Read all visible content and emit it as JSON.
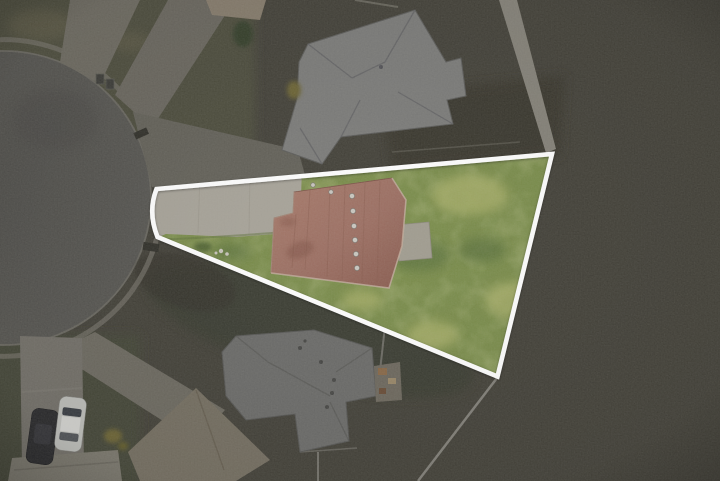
{
  "scene": {
    "kind": "aerial-drone-photo",
    "subject": "wedge-shaped residential lot on a cul-de-sac, highlighted with a white property-boundary outline; surroundings dimmed",
    "features": [
      "cul-de-sac road",
      "highlighted lot with concrete driveway",
      "red-brown shingle roof house",
      "back lawn",
      "neighbor house north",
      "neighbor house south",
      "parked white car",
      "parked dark car",
      "sidewalk path along north-east lot line"
    ]
  },
  "overlay": {
    "boundary_path": "M 156.5,189 L 552,154 L 497.5,376.5 L 157.5,237 Q 147.5,212 156.5,189 Z",
    "boundary_color": "#ffffff",
    "boundary_stroke_width": "4.6"
  },
  "colors": {
    "field_dark": "#46443c",
    "grass_dim": "#4f5040",
    "grass_dim_dark": "#3c3b32",
    "road": "#535250",
    "road_edge": "#6b6962",
    "sidewalk": "#75726a",
    "concrete_dim": "#6e6b62",
    "concrete_apron": "#65635b",
    "driveway_dim_bright": "#74716a",
    "tan_roof_corner": "#877d6e",
    "neighbor_roof_top": "#7d7d7b",
    "neighbor_roof_bottom": "#6d6d6b",
    "roof_tan": "#767063",
    "roof_gray": "#7b786e",
    "path_light": "#86837a",
    "fence": "#83817a",
    "car_dark": "#2d2d2f",
    "car_white": "#bcbdb9",
    "bush_yellow": "#6e6637",
    "shrub_dark": "#39432f",
    "lot_grass": "#7c8e4e",
    "lot_grass_light": "#a6ad69",
    "lot_grass_dark": "#5d7340",
    "lot_driveway": "#a8a49a",
    "patio": "#a19d91",
    "roof_red": "#9c7064",
    "roof_red_light": "#a87c6d",
    "roof_red_dark": "#8a5e52",
    "vent": "#c9c6bf"
  }
}
